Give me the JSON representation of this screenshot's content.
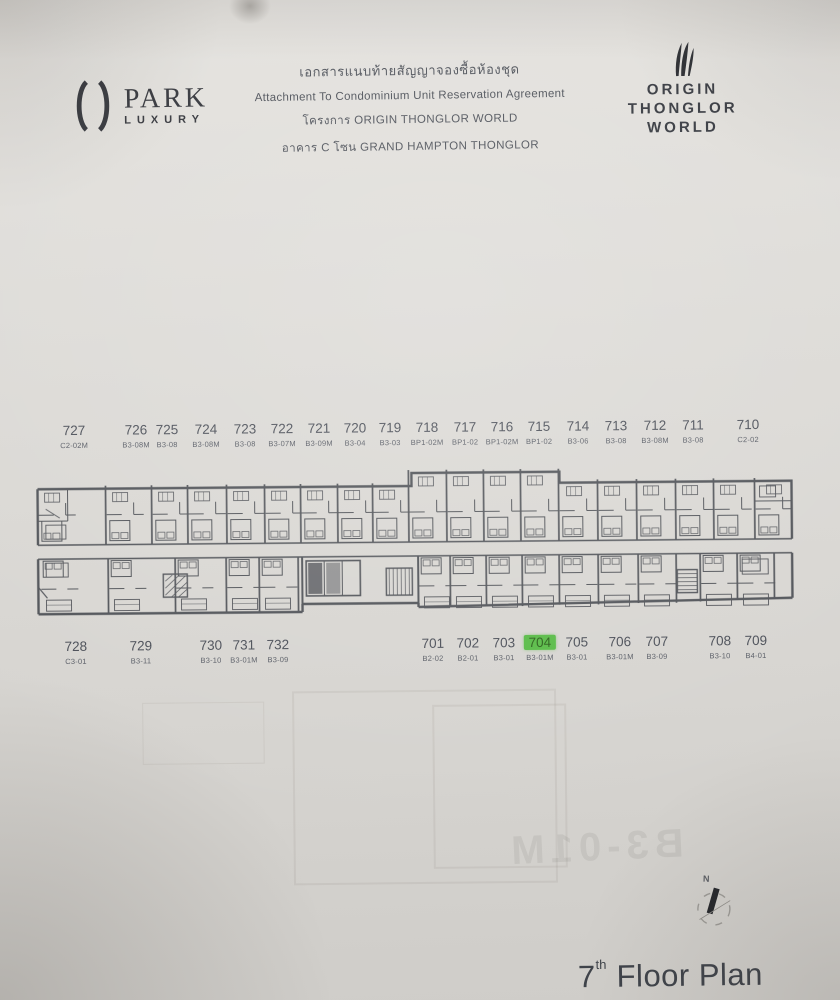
{
  "document": {
    "brand_left": {
      "name": "PARK",
      "sub": "LUXURY"
    },
    "brand_right": {
      "line1": "ORIGIN",
      "line2": "THONGLOR",
      "line3": "WORLD"
    },
    "header": {
      "title_th": "เอกสารแนบท้ายสัญญาจองซื้อห้องชุด",
      "title_en": "Attachment To Condominium Unit Reservation Agreement",
      "project_line": "โครงการ  ORIGIN THONGLOR WORLD",
      "building_line": "อาคาร C โซน GRAND HAMPTON THONGLOR"
    },
    "floor_plan": {
      "floor": "7",
      "highlighted_unit": "704",
      "highlight_color": "#57bb45",
      "bleedthrough_text": "B3-01M",
      "units_top": [
        {
          "no": "727",
          "code": "C2-02M",
          "x": 75
        },
        {
          "no": "726",
          "code": "B3-08M",
          "x": 137
        },
        {
          "no": "725",
          "code": "B3-08",
          "x": 168
        },
        {
          "no": "724",
          "code": "B3-08M",
          "x": 207
        },
        {
          "no": "723",
          "code": "B3-08",
          "x": 246
        },
        {
          "no": "722",
          "code": "B3-07M",
          "x": 283
        },
        {
          "no": "721",
          "code": "B3-09M",
          "x": 320
        },
        {
          "no": "720",
          "code": "B3-04",
          "x": 356
        },
        {
          "no": "719",
          "code": "B3-03",
          "x": 391
        },
        {
          "no": "718",
          "code": "BP1-02M",
          "x": 428
        },
        {
          "no": "717",
          "code": "BP1-02",
          "x": 466
        },
        {
          "no": "716",
          "code": "BP1-02M",
          "x": 503
        },
        {
          "no": "715",
          "code": "BP1-02",
          "x": 540
        },
        {
          "no": "714",
          "code": "B3-06",
          "x": 579
        },
        {
          "no": "713",
          "code": "B3-08",
          "x": 617
        },
        {
          "no": "712",
          "code": "B3-08M",
          "x": 656
        },
        {
          "no": "711",
          "code": "B3-08",
          "x": 694
        },
        {
          "no": "710",
          "code": "C2-02",
          "x": 749
        }
      ],
      "units_bottom": [
        {
          "no": "728",
          "code": "C3-01",
          "x": 75
        },
        {
          "no": "729",
          "code": "B3-11",
          "x": 140
        },
        {
          "no": "730",
          "code": "B3-10",
          "x": 210
        },
        {
          "no": "731",
          "code": "B3-01M",
          "x": 243
        },
        {
          "no": "732",
          "code": "B3-09",
          "x": 277
        },
        {
          "no": "701",
          "code": "B2-02",
          "x": 432
        },
        {
          "no": "702",
          "code": "B2-01",
          "x": 467
        },
        {
          "no": "703",
          "code": "B3-01",
          "x": 503
        },
        {
          "no": "704",
          "code": "B3-01M",
          "x": 539,
          "highlight": true
        },
        {
          "no": "705",
          "code": "B3-01",
          "x": 576
        },
        {
          "no": "706",
          "code": "B3-01M",
          "x": 619
        },
        {
          "no": "707",
          "code": "B3-09",
          "x": 656
        },
        {
          "no": "708",
          "code": "B3-10",
          "x": 719
        },
        {
          "no": "709",
          "code": "B4-01",
          "x": 755
        }
      ]
    },
    "footer": {
      "floor_number": "7",
      "floor_suffix": "th",
      "floor_label": "Floor Plan",
      "compass_n": "N"
    }
  },
  "colors": {
    "paper": "#dad8d4",
    "ink": "#45484e",
    "label_text": "#4a4e57",
    "highlight": "#57bb45"
  }
}
